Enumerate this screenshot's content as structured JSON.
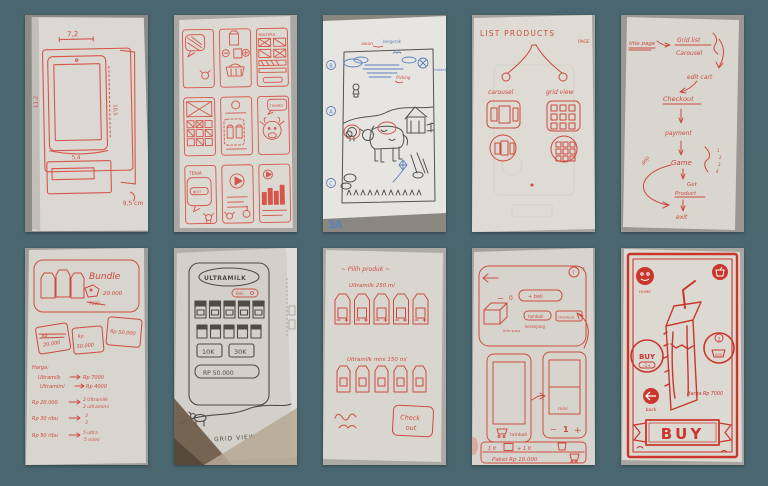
{
  "board": {
    "background": "#4a666e"
  },
  "icons": {
    "cart-icon": "🛒",
    "play-icon": "▶",
    "back-arrow-icon": "←",
    "question-icon": "?",
    "home-icon": "⌂",
    "sun-icon": "☀",
    "kite-icon": "◇",
    "speech-bubble-icon": "💬"
  },
  "s1": {
    "m_top": "7,2",
    "m_left": "11,2",
    "m_right": "10,5",
    "m_inner": "5,4",
    "m_corner": "9,5 cm"
  },
  "s2": {
    "multiple": "MULTIPLE",
    "thanks": "THANKS",
    "tenia": "TENIA",
    "next": "NEXT"
  },
  "s3": {
    "awan": "awan",
    "bergerak": "bergerak",
    "matahari": "matahari",
    "flicking": "flicking",
    "b": "B",
    "a": "A",
    "c": "C",
    "corner": "3A"
  },
  "s4": {
    "title": "LIST PRODUCTS",
    "page": "PAGE",
    "carousel": "carousel",
    "grid_view": "grid view"
  },
  "s5": {
    "title_page": "title page",
    "grid_list": "Grid list",
    "carousel": "Carousel",
    "edit_cart": "edit cart",
    "checkout": "Checkout",
    "payment": "payment",
    "game": "Game",
    "n1": "1",
    "n2": "2",
    "n3": "3",
    "n4": "4",
    "get": "Get",
    "product": "Product",
    "exit": "exit",
    "skip": "skip"
  },
  "s6": {
    "bundle": "Bundle",
    "price_new": "20.000",
    "price_old": "7000",
    "tag1a": "Rp",
    "tag1b": "20.000",
    "tag2a": "Rp",
    "tag2b": "30.000",
    "tag3": "Rp 50.000",
    "harga": "Harga:",
    "l1a": "Ultramilk",
    "l1b": "Rp 7000",
    "l2a": "Ultramimi",
    "l2b": "Rp 4000",
    "l3a": "Rp 20.000",
    "l3b": "2 Ultramilk",
    "l3c": "2 ultramimi",
    "l4a": "Rp 30 ribu",
    "l4b": "3",
    "l4c": "3",
    "l5a": "Rp 50 ribu",
    "l5b": "5 ultra",
    "l5c": "5 mimi"
  },
  "s7": {
    "logo": "ULTRAMILK",
    "beli": "Beli",
    "k10": "10K",
    "k30": "30K",
    "price": "RP 50.000",
    "caption": "GRID VIEW"
  },
  "s8": {
    "title": "~ Pilih produk ~",
    "row1": "Ultramilk 250 ml",
    "row2": "Ultramilk mini 150 ml",
    "co1": "Check",
    "co2": "out"
  },
  "s9": {
    "minus": "−",
    "zero": "0",
    "beli": "+ beli",
    "info": "info susu",
    "tambah": "tambah",
    "keranjang": "keranjang",
    "checkout": "checkout",
    "mini": "mini",
    "one": "1",
    "plus": "+",
    "lt": "1 lt",
    "paket": "Paket Rp 10.000",
    "q": "?"
  },
  "s10": {
    "home": "HOME",
    "buy_side": "BUY",
    "stepper": "-1+",
    "qty": "2",
    "cart_val": "000",
    "harga": "Harga Rp 7000",
    "back": "back",
    "buy_main": "BUY"
  }
}
